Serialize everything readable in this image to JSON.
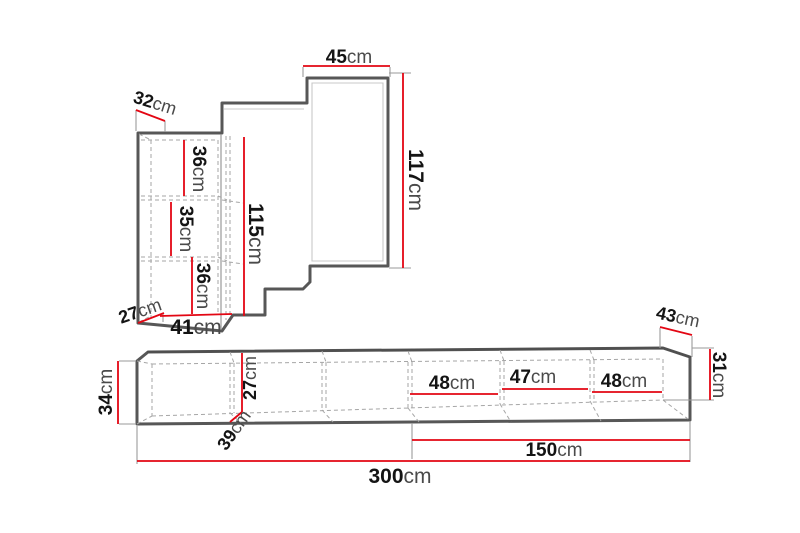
{
  "diagram_type": "furniture-dimension-diagram",
  "colors": {
    "dimension_line": "#e30613",
    "outline": "#575757",
    "hidden_line": "#a6a6a6",
    "label_number": "#141414",
    "label_unit": "#4a4a4a",
    "background": "#ffffff"
  },
  "wall_unit": {
    "dimensions": {
      "top_panel_width": {
        "value": "45",
        "unit": "cm"
      },
      "right_panel_height": {
        "value": "117",
        "unit": "cm"
      },
      "top_depth": {
        "value": "32",
        "unit": "cm"
      },
      "compartment_top": {
        "value": "36",
        "unit": "cm"
      },
      "compartment_middle": {
        "value": "35",
        "unit": "cm"
      },
      "compartment_bottom": {
        "value": "36",
        "unit": "cm"
      },
      "cabinet_height": {
        "value": "115",
        "unit": "cm"
      },
      "bottom_depth": {
        "value": "27",
        "unit": "cm"
      },
      "cabinet_width": {
        "value": "41",
        "unit": "cm"
      }
    }
  },
  "bench": {
    "dimensions": {
      "height": {
        "value": "34",
        "unit": "cm"
      },
      "depth": {
        "value": "39",
        "unit": "cm"
      },
      "inner_height": {
        "value": "27",
        "unit": "cm"
      },
      "compartment_left": {
        "value": "48",
        "unit": "cm"
      },
      "compartment_center": {
        "value": "47",
        "unit": "cm"
      },
      "compartment_right": {
        "value": "48",
        "unit": "cm"
      },
      "end_depth": {
        "value": "43",
        "unit": "cm"
      },
      "end_height": {
        "value": "31",
        "unit": "cm"
      },
      "right_section_length": {
        "value": "150",
        "unit": "cm"
      },
      "total_length": {
        "value": "300",
        "unit": "cm"
      }
    }
  }
}
